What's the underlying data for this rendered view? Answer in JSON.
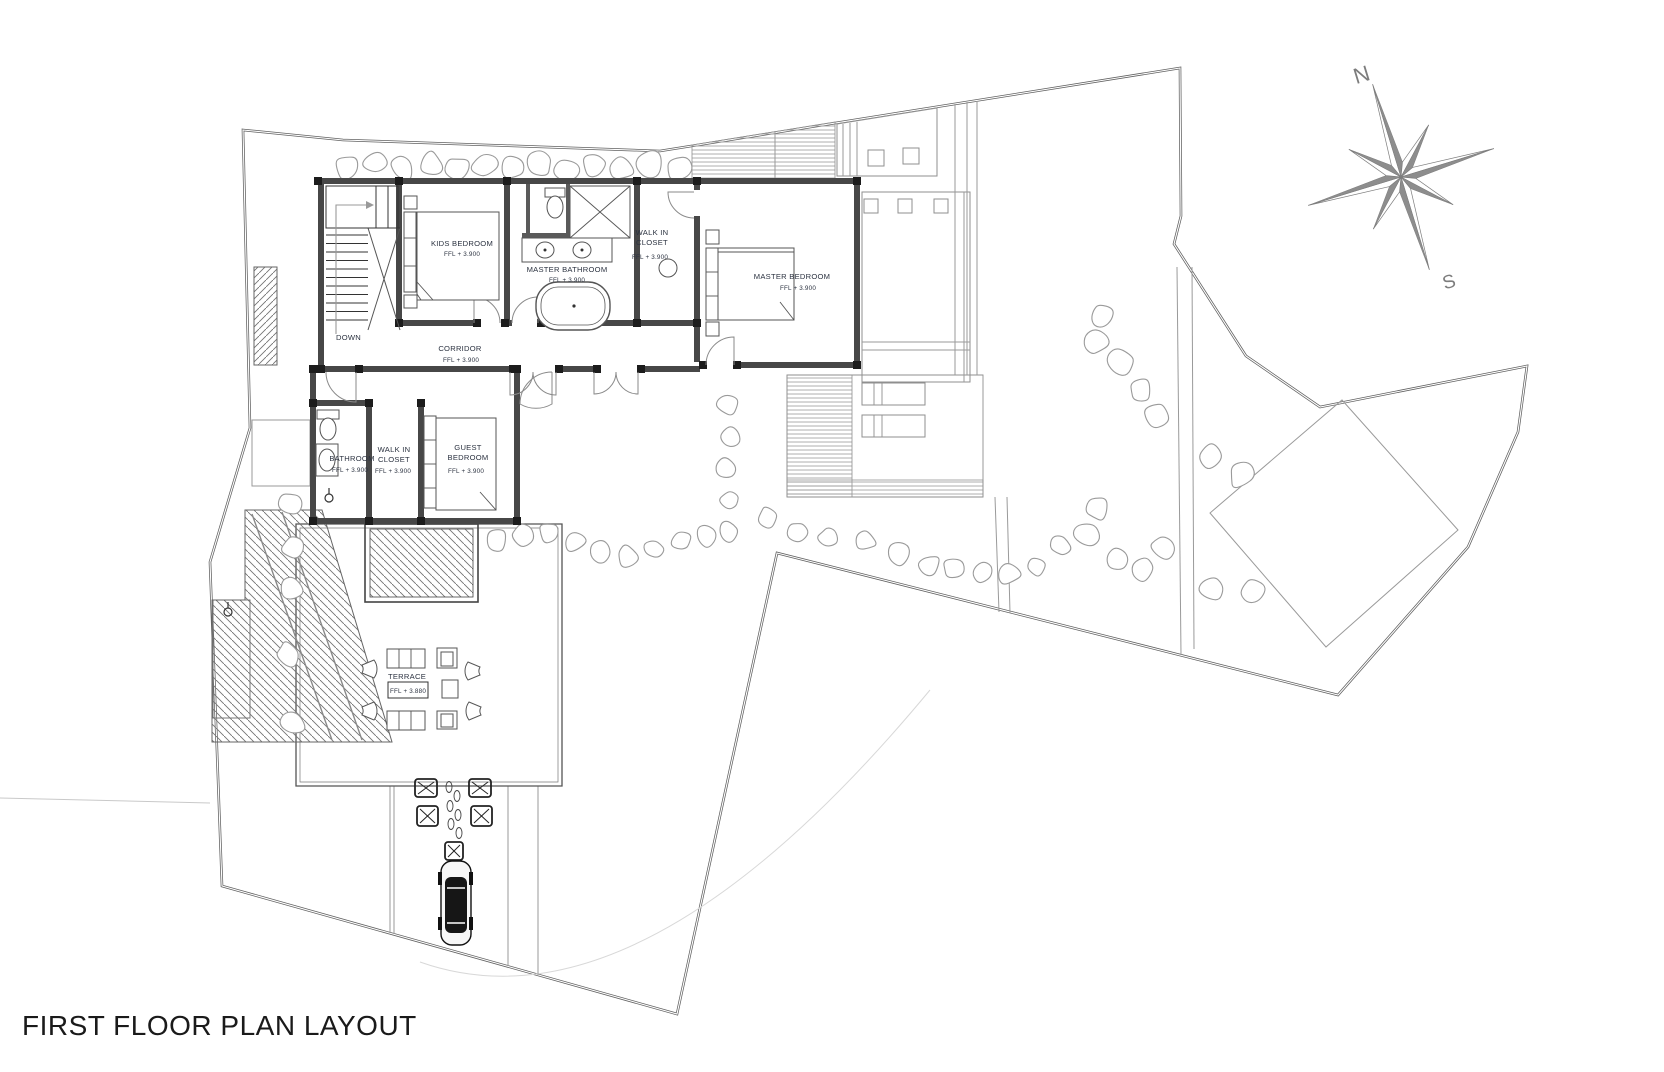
{
  "title": "FIRST FLOOR PLAN LAYOUT",
  "compass": {
    "north": "N",
    "south": "S"
  },
  "stair": {
    "label": "DOWN"
  },
  "rooms": {
    "kids_bedroom": {
      "name": "KIDS BEDROOM",
      "level": "FFL + 3.900"
    },
    "master_bathroom": {
      "name": "MASTER BATHROOM",
      "level": "FFL + 3.900"
    },
    "master_closet": {
      "line1": "WALK IN",
      "line2": "CLOSET",
      "level": "FFL + 3.900"
    },
    "master_bedroom": {
      "name": "MASTER BEDROOM",
      "level": "FFL + 3.900"
    },
    "corridor": {
      "name": "CORRIDOR",
      "level": "FFL + 3.900"
    },
    "guest_bathroom": {
      "name": "BATHROOM",
      "level": "FFL + 3.900"
    },
    "guest_closet": {
      "line1": "WALK IN",
      "line2": "CLOSET",
      "level": "FFL + 3.900"
    },
    "guest_bedroom": {
      "line1": "GUEST",
      "line2": "BEDROOM",
      "level": "FFL + 3.900"
    },
    "terrace": {
      "name": "TERRACE",
      "level": "FFL + 3.880"
    }
  },
  "colors": {
    "wall": "#474747",
    "column": "#1c1c1c",
    "label": "#2b3240",
    "boundary": "#606060",
    "gray_line": "#8f8f8f",
    "compass_dark": "#8d8d8d",
    "title": "#1a1a1a"
  }
}
